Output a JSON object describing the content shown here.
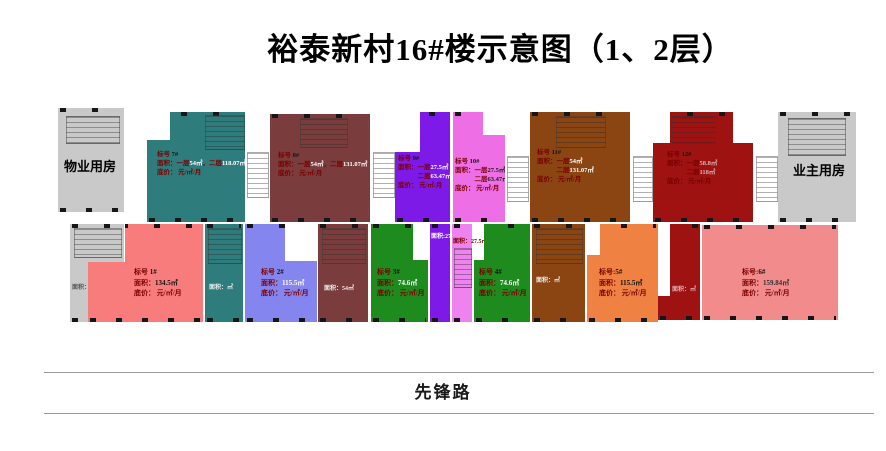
{
  "title": "裕泰新村16#楼示意图（1、2层）",
  "road": {
    "name": "先锋路"
  },
  "rooms": {
    "property": "物业用房",
    "owner": "业主用房"
  },
  "colors": {
    "room": "#C9C9C9",
    "teal": "#2E7C7C",
    "maroon": "#7A3C3C",
    "purple": "#7D1AE8",
    "magenta": "#EE6EE6",
    "brown": "#8B4513",
    "dark_red": "#9E1212",
    "salmon": "#F87C7C",
    "periwinkle": "#8585F0",
    "green": "#1E8B1E",
    "orange": "#EF8142",
    "pink": "#F28B8B",
    "label_text": "#7a0000"
  },
  "units": {
    "u7": {
      "color": "#2E7C7C",
      "num_color": "#FFFFFF",
      "lines": [
        [
          [
            "标号  ",
            0
          ],
          [
            "7#",
            2
          ]
        ],
        [
          [
            "面积：一层",
            0
          ],
          [
            "54㎡",
            1
          ],
          [
            "，二层",
            0
          ],
          [
            "118.07㎡",
            1
          ]
        ],
        [
          [
            "底价：      元/㎡/月",
            0
          ]
        ]
      ]
    },
    "u8": {
      "color": "#7A3C3C",
      "num_color": "#FFFFFF",
      "lines": [
        [
          [
            "标号  ",
            0
          ],
          [
            "8#",
            2
          ]
        ],
        [
          [
            "面积：一层",
            0
          ],
          [
            "54㎡",
            1
          ],
          [
            "，二层",
            0
          ],
          [
            "131.07㎡",
            1
          ]
        ],
        [
          [
            "底价：      元/㎡/月",
            0
          ]
        ]
      ]
    },
    "u9": {
      "color": "#7D1AE8",
      "num_color": "#FFFFFF",
      "lines": [
        [
          [
            "标号  ",
            0
          ],
          [
            "9#",
            2
          ]
        ],
        [
          [
            "面积：一层",
            0
          ],
          [
            "27.5㎡",
            1
          ]
        ],
        [
          [
            "　　　二层",
            0
          ],
          [
            "63.47㎡",
            1
          ]
        ],
        [
          [
            "底价：    元/㎡/月",
            0
          ]
        ]
      ]
    },
    "u10": {
      "color": "#EE6EE6",
      "num_color": "#1B1B1B",
      "lines": [
        [
          [
            "标号  ",
            0
          ],
          [
            "10#",
            2
          ]
        ],
        [
          [
            "面积：一层",
            0
          ],
          [
            "27.5㎡",
            1
          ]
        ],
        [
          [
            "　　　二层",
            0
          ],
          [
            "63.47㎡",
            1
          ]
        ],
        [
          [
            "底价：    元/㎡/月",
            0
          ]
        ]
      ]
    },
    "u11": {
      "color": "#8B4513",
      "num_color": "#FFFFFF",
      "lines": [
        [
          [
            "标号  ",
            0
          ],
          [
            "11#",
            2
          ]
        ],
        [
          [
            "面积：一层",
            0
          ],
          [
            "54㎡",
            1
          ]
        ],
        [
          [
            "　　　二层",
            0
          ],
          [
            "131.07㎡",
            1
          ]
        ],
        [
          [
            "底价：      元/㎡/月",
            0
          ]
        ]
      ]
    },
    "u12": {
      "color": "#9E1212",
      "num_color": "#E0B0B0",
      "lines": [
        [
          [
            "标号  ",
            0
          ],
          [
            "12#",
            2
          ]
        ],
        [
          [
            "面积：一层",
            0
          ],
          [
            "58.8㎡",
            1
          ]
        ],
        [
          [
            "　　　二层",
            0
          ],
          [
            "118㎡",
            1
          ]
        ],
        [
          [
            "底价：    元/㎡/月",
            0
          ]
        ]
      ]
    },
    "u1": {
      "color": "#F87C7C",
      "num_color": "#111111",
      "lines": [
        [
          [
            "标号  ",
            0
          ],
          [
            "1#",
            2
          ]
        ],
        [
          [
            "面积：",
            0
          ],
          [
            "134.5㎡",
            1
          ]
        ],
        [
          [
            "底价：    元/㎡/月",
            0
          ]
        ]
      ]
    },
    "u2": {
      "color": "#8585F0",
      "num_color": "#FFFFFF",
      "lines": [
        [
          [
            "标号  ",
            0
          ],
          [
            "2#",
            2
          ]
        ],
        [
          [
            "面积：",
            0
          ],
          [
            "115.5㎡",
            1
          ]
        ],
        [
          [
            "底价：    元/㎡/月",
            0
          ]
        ]
      ]
    },
    "u3": {
      "color": "#1E8B1E",
      "num_color": "#FFFFFF",
      "lines": [
        [
          [
            "标号  ",
            0
          ],
          [
            "3#",
            2
          ]
        ],
        [
          [
            "面积：",
            0
          ],
          [
            "74.6㎡",
            1
          ]
        ],
        [
          [
            "底价：    元/㎡/月",
            0
          ]
        ]
      ]
    },
    "u4": {
      "color": "#1E8B1E",
      "num_color": "#FFFFFF",
      "lines": [
        [
          [
            "标号  ",
            0
          ],
          [
            "4#",
            2
          ]
        ],
        [
          [
            "面积：",
            0
          ],
          [
            "74.6㎡",
            1
          ]
        ],
        [
          [
            "底价：    元/㎡/月",
            0
          ]
        ]
      ]
    },
    "u5": {
      "color": "#EF8142",
      "num_color": "#111111",
      "lines": [
        [
          [
            "标号:",
            0
          ],
          [
            "5#",
            2
          ]
        ],
        [
          [
            "面积：",
            0
          ],
          [
            "115.5㎡",
            1
          ]
        ],
        [
          [
            "底价：    元/㎡/月",
            0
          ]
        ]
      ]
    },
    "u6": {
      "color": "#F28B8B",
      "num_color": "#333333",
      "lines": [
        [
          [
            "标号:",
            0
          ],
          [
            "6#",
            2
          ]
        ],
        [
          [
            "面积：",
            0
          ],
          [
            "159.84㎡",
            1
          ]
        ],
        [
          [
            "底价：    元/㎡/月",
            0
          ]
        ]
      ]
    }
  },
  "slivers": {
    "gray": {
      "color": "#C9C9C9",
      "label": "面积：㎡",
      "label_color": "#555555"
    },
    "teal": {
      "color": "#2E7C7C",
      "label": "面积：㎡",
      "label_color": "#EEEEEE"
    },
    "brownred": {
      "color": "#7A3C3C",
      "label": "面积：54㎡",
      "label_color": "#EEEEEE"
    },
    "purple": {
      "color": "#7D1AE8",
      "label": "面积:27.5㎡",
      "label_color": "#FFFFFF"
    },
    "pink": {
      "color": "#EE82EE",
      "label": "面积：27.5㎡",
      "label_color": "#7a0000"
    },
    "brown": {
      "color": "#8B4513",
      "label": "面积：㎡",
      "label_color": "#EEEEEE"
    },
    "darkred": {
      "color": "#9E1212",
      "label": "面积：㎡",
      "label_color": "#E0B0B0"
    }
  }
}
